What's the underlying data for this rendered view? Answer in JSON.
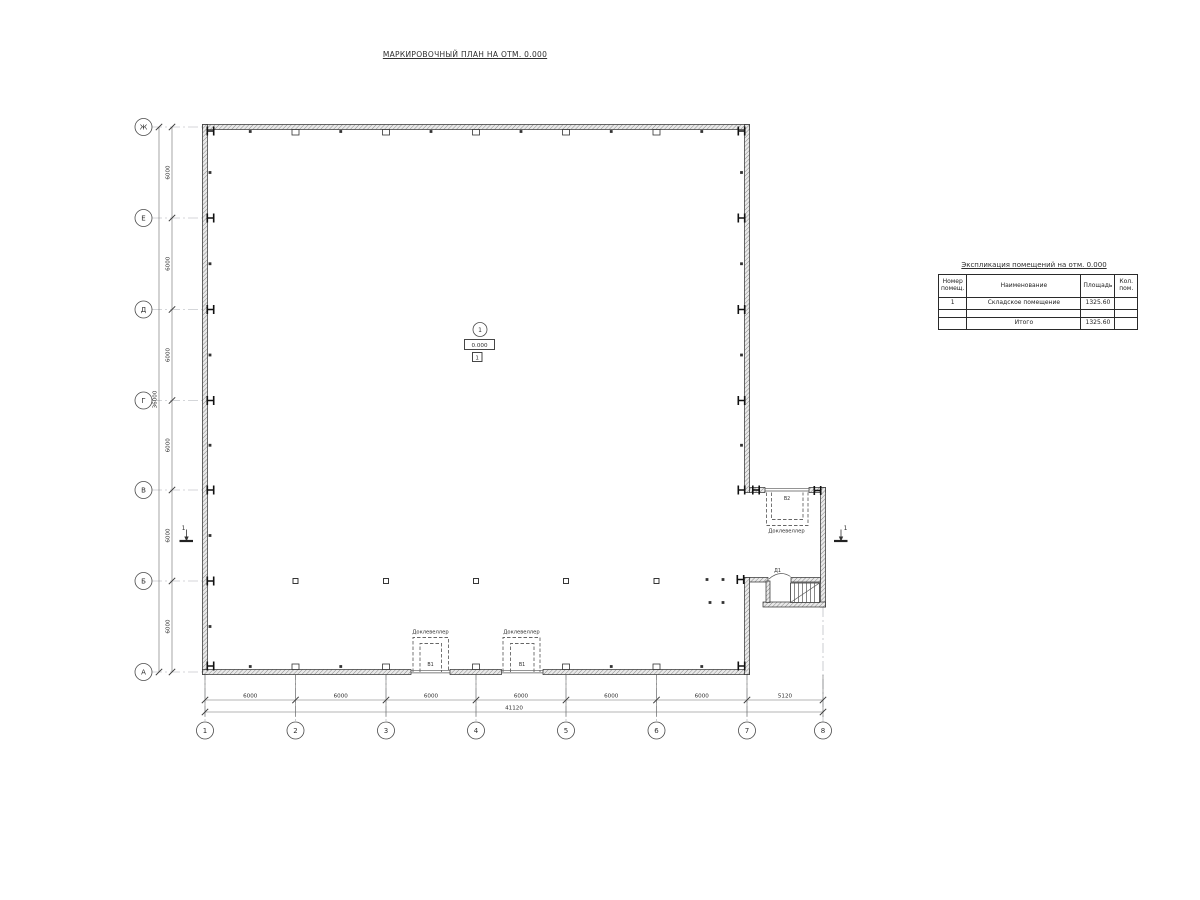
{
  "title": "МАРКИРОВОЧНЫЙ ПЛАН НА ОТМ. 0.000",
  "axes": {
    "rows": [
      "Ж",
      "Е",
      "Д",
      "Г",
      "В",
      "Б",
      "А"
    ],
    "cols": [
      "1",
      "2",
      "3",
      "4",
      "5",
      "6",
      "7",
      "8"
    ]
  },
  "dims": {
    "left_segments": [
      "6000",
      "6000",
      "6000",
      "6000",
      "6000",
      "6000"
    ],
    "left_total": "36000",
    "bottom_segments": [
      "6000",
      "6000",
      "6000",
      "6000",
      "6000",
      "6000",
      "5120"
    ],
    "bottom_total": "41120"
  },
  "room_tag": {
    "number": "1",
    "elevation": "0.000",
    "finish": "1"
  },
  "marks": {
    "section": "1"
  },
  "labels": {
    "dock_leveler": "Доклевеллер",
    "gate_b1": "В1",
    "gate_b2": "В2",
    "door_d1": "Д1"
  },
  "table": {
    "title": "Экспликация помещений на отм. 0.000",
    "headers": {
      "num": "Номер\nпомещ.",
      "name": "Наименование",
      "area": "Площадь",
      "count": "Кол.\nпом."
    },
    "rows": [
      {
        "num": "1",
        "name": "Складское помещение",
        "area": "1325.60",
        "count": ""
      }
    ],
    "total_label": "Итого",
    "total_area": "1325.60"
  }
}
